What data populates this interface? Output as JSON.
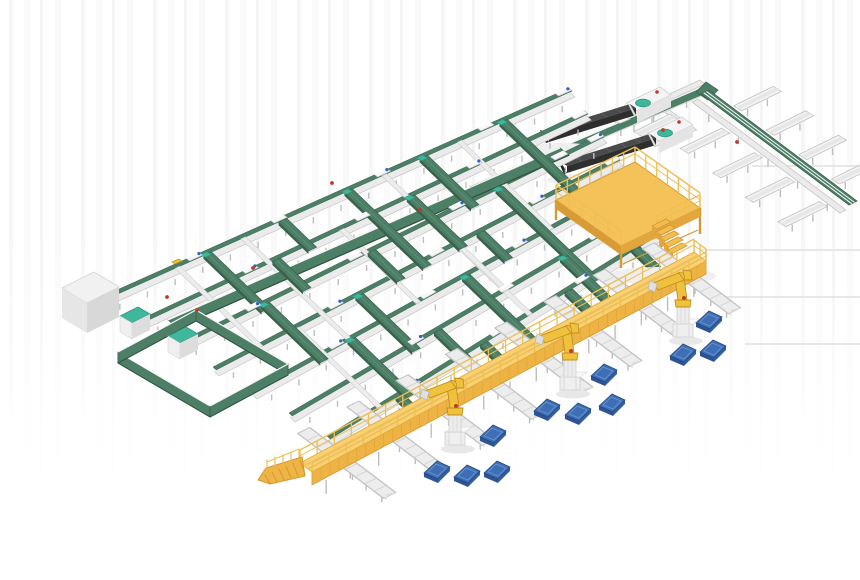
{
  "meta": {
    "title": "Automated conveyor sortation and robotic palletizing system - 3D render",
    "canvas_w": 860,
    "canvas_h": 580
  },
  "palette": {
    "green_top": "#4c7f66",
    "green_dark": "#39624d",
    "green_edge": "#declared",
    "teal": "#3eb79c",
    "teal_dark": "#2e9881",
    "conv_white": "#ebebeb",
    "conv_stroke": "#c6c6c6",
    "rail_light": "#f7f7f7",
    "cross_white": "#ececec",
    "leg": "#bdbdbd",
    "station_fill": "#f8f8f8",
    "station_stroke": "#c9c9c9",
    "dot_blue": "#2f5fd0",
    "dark_machine_top": "#4a4a4a",
    "dark_machine_side": "#2e2e2e",
    "dark_rib": "#5e5e5e",
    "yellow_top": "#f9d173",
    "yellow_front": "#edb445",
    "yellow_dark": "#d6972f",
    "yellow_rail": "#eebf55",
    "robot_yellow": "#efc13d",
    "robot_stroke": "#c08f1f",
    "robot_grey": "#ececec",
    "pallet_top": "#3e6eb5",
    "pallet_side": "#2d5295",
    "pallet_frame": "#6290cc",
    "pallet_stroke": "#27497f",
    "red_item": "#c03a2b",
    "yellow_item": "#e7c430",
    "shadow_line": "#e7e7e7",
    "soft_shadow": "#efefef",
    "trough_fill": "#f3f3f3",
    "trough_inner": "#e7e7e7",
    "trough_stroke": "#c5c5c5"
  },
  "scene": {
    "axisA_grid": [
      0.72,
      0.69
    ],
    "axisA_floor": [
      0.8,
      0.6
    ],
    "axisB": [
      0.9,
      -0.44
    ],
    "grid": {
      "lines": [
        {
          "a": [
            100,
            302
          ],
          "b": [
            570,
            92
          ]
        },
        {
          "a": [
            138,
            325
          ],
          "b": [
            586,
            115
          ]
        },
        {
          "a": [
            176,
            348
          ],
          "b": [
            602,
            138
          ]
        },
        {
          "a": [
            214,
            371
          ],
          "b": [
            618,
            161
          ]
        },
        {
          "a": [
            252,
            394
          ],
          "b": [
            634,
            184
          ]
        },
        {
          "a": [
            290,
            417
          ],
          "b": [
            650,
            207
          ]
        },
        {
          "a": [
            328,
            440
          ],
          "b": [
            666,
            230
          ]
        }
      ],
      "station_fracs": [
        [
          0.2,
          0.38,
          0.6,
          0.82
        ],
        [
          0.25,
          0.5,
          0.75
        ],
        [
          0.18,
          0.42,
          0.66,
          0.9
        ],
        [
          0.3,
          0.55,
          0.8
        ],
        [
          0.22,
          0.46,
          0.7,
          0.94
        ],
        [
          0.35,
          0.6,
          0.85
        ],
        [
          0.25,
          0.5,
          0.75
        ]
      ],
      "green_cross": [
        [
          0,
          0.22,
          2
        ],
        [
          0,
          0.38,
          1
        ],
        [
          0,
          0.52,
          3
        ],
        [
          0,
          0.68,
          2
        ],
        [
          0,
          0.85,
          7
        ],
        [
          1,
          0.3,
          1
        ],
        [
          1,
          0.6,
          2
        ],
        [
          2,
          0.2,
          2
        ],
        [
          2,
          0.45,
          1
        ],
        [
          2,
          0.75,
          4
        ],
        [
          3,
          0.35,
          2
        ],
        [
          3,
          0.65,
          1
        ],
        [
          4,
          0.25,
          2
        ],
        [
          4,
          0.55,
          3
        ],
        [
          5,
          0.4,
          1
        ],
        [
          5,
          0.75,
          2
        ],
        [
          6,
          0.2,
          1
        ],
        [
          6,
          0.45,
          1
        ],
        [
          6,
          0.7,
          1
        ],
        [
          6,
          0.9,
          1
        ]
      ],
      "white_cross": [
        [
          0,
          0.16,
          3
        ],
        [
          0,
          0.3,
          6
        ],
        [
          0,
          0.6,
          6
        ],
        [
          0,
          0.76,
          4
        ],
        [
          1,
          0.45,
          3
        ],
        [
          2,
          0.6,
          3
        ],
        [
          3,
          0.2,
          3
        ]
      ],
      "collector": {
        "a": [
          168,
          320
        ],
        "b": [
          560,
          148
        ],
        "w": 12
      }
    },
    "loop": {
      "pts": [
        [
          196,
          310
        ],
        [
          288,
          364
        ],
        [
          210,
          406
        ],
        [
          118,
          352
        ]
      ],
      "w": 11,
      "teal_boxes": [
        [
          120,
          316
        ],
        [
          168,
          336
        ]
      ]
    },
    "white_box": {
      "p": [
        62,
        288
      ]
    },
    "loaders": [
      {
        "boom_a": [
          543,
          131
        ],
        "boom_b": [
          630,
          104
        ],
        "base": [
          626,
          103
        ]
      },
      {
        "boom_a": [
          561,
          162
        ],
        "boom_b": [
          650,
          134
        ],
        "base": [
          648,
          133
        ]
      }
    ],
    "topright": {
      "trunk1": {
        "a": [
          470,
          186
        ],
        "b": [
          700,
          88
        ]
      },
      "top_line": {
        "a": [
          612,
          120
        ],
        "b": [
          700,
          80
        ]
      },
      "branch": {
        "a": [
          648,
          100
        ],
        "b": [
          692,
          132
        ]
      },
      "top_troughs": [
        [
          657,
          104
        ],
        [
          670,
          114
        ],
        [
          683,
          124
        ]
      ],
      "trunk2_white": {
        "a": [
          692,
          102
        ],
        "b": [
          840,
          213
        ]
      },
      "trunk2_green": {
        "a": [
          701,
          94
        ],
        "b": [
          849,
          205
        ]
      },
      "troughs_lower_f": [
        0.2,
        0.42,
        0.64,
        0.86
      ],
      "troughs_upper_f": [
        0.16,
        0.38,
        0.6,
        0.82
      ]
    },
    "mezzanine": {
      "p1": [
        556,
        200
      ],
      "vB": [
        79,
        -38
      ],
      "vA": [
        65,
        46
      ],
      "leg_h": 24,
      "stair_steps": 5
    },
    "walkway": {
      "a": [
        300,
        463
      ],
      "b": [
        694,
        252
      ],
      "w": 15,
      "spur_t": [
        0.055,
        0.18,
        0.305,
        0.43,
        0.555,
        0.68,
        0.805,
        0.93
      ]
    },
    "robots": [
      [
        455,
        445
      ],
      [
        570,
        390
      ],
      [
        683,
        337
      ]
    ],
    "pallets": [
      [
        709,
        320
      ],
      [
        683,
        353
      ],
      [
        713,
        349
      ],
      [
        604,
        373
      ],
      [
        547,
        408
      ],
      [
        578,
        412
      ],
      [
        612,
        403
      ],
      [
        493,
        434
      ],
      [
        437,
        470
      ],
      [
        467,
        474
      ],
      [
        497,
        470
      ]
    ],
    "shadow_lines": [
      [
        700,
        250,
        860
      ],
      [
        718,
        297,
        860
      ],
      [
        745,
        344,
        860
      ],
      [
        752,
        166,
        860
      ]
    ],
    "red_items": [
      [
        332,
        183
      ],
      [
        253,
        268
      ],
      [
        197,
        310
      ],
      [
        663,
        130
      ],
      [
        737,
        142
      ],
      [
        420,
        210
      ],
      [
        167,
        297
      ]
    ],
    "yellow_items": [
      [
        172,
        262
      ]
    ]
  }
}
